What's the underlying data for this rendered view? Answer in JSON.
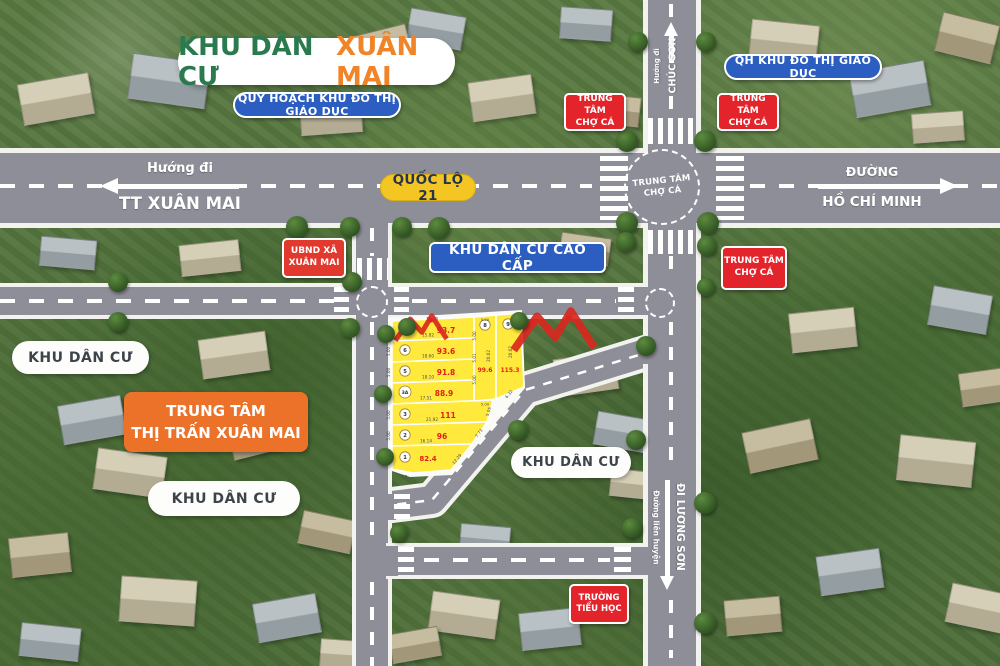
{
  "title": {
    "part1": "KHU DÂN CƯ",
    "part2": "XUÂN MAI"
  },
  "badges": {
    "quy_hoach": "QUY HOẠCH KHU ĐÔ THỊ GIÁO DỤC",
    "qh_giao_duc": "QH KHU ĐÔ THỊ GIÁO DỤC",
    "cho_ca_line1": "TRUNG TÂM",
    "cho_ca_line2": "CHỢ CÁ",
    "quoc_lo": "QUỐC LỘ 21",
    "ubnd_line1": "UBND XÃ",
    "ubnd_line2": "XUÂN MAI",
    "cao_cap": "KHU DÂN CƯ CAO CẤP",
    "khu_dan_cu": "KHU DÂN CƯ",
    "trung_tam_line1": "TRUNG TÂM",
    "trung_tam_line2": "THỊ TRẤN XUÂN MAI",
    "truong_line1": "TRƯỜNG",
    "truong_line2": "TIỂU HỌC"
  },
  "directions": {
    "west_small": "Hướng đi",
    "west_big": "TT XUÂN MAI",
    "east_small": "ĐƯỜNG",
    "east_big": "HỒ CHÍ MINH",
    "north_small": "Hướng đi",
    "north_big": "CHÚC SƠN",
    "south_small": "Đường liên huyện",
    "south_big": "ĐI LƯƠNG SƠN"
  },
  "roundabout": {
    "line1": "TRUNG TÂM",
    "line2": "CHỢ CÁ"
  },
  "plots": {
    "p1": {
      "num": "1",
      "area": "82.4",
      "w": "7.3",
      "e": "5.00",
      "d": "12.29"
    },
    "p2": {
      "num": "2",
      "area": "96",
      "w": "16.14",
      "e": "5.00",
      "d": "7.73"
    },
    "p3": {
      "num": "3",
      "area": "111",
      "w": "21.92",
      "e": "5.00",
      "d": "5.05"
    },
    "p3a": {
      "num": "3A",
      "area": "88.9",
      "w": "17.51",
      "e": "5.00"
    },
    "p5": {
      "num": "5",
      "area": "91.8",
      "w": "18.10",
      "e": "5.00"
    },
    "p6": {
      "num": "6",
      "area": "93.6",
      "w": "18.60",
      "e": "5.00"
    },
    "p7": {
      "num": "7",
      "area": "93.7",
      "w": "15.82",
      "t": "17.80",
      "e": "5.32"
    },
    "p8": {
      "num": "8",
      "area": "99.6",
      "h": "20.02",
      "t": "5.00",
      "e1": "5.00",
      "e2": "5.01",
      "e3": "5.00",
      "b": "5.00"
    },
    "p9": {
      "num": "9",
      "area": "115.3",
      "h": "20.07",
      "b": "6.32"
    }
  },
  "colors": {
    "road": "#8d8e97",
    "plot_yellow": "#ffe93d",
    "badge_red": "#e3242b",
    "badge_blue": "#2b5ec0",
    "badge_orange": "#ed7229",
    "title_green": "#2a7a4d",
    "title_orange": "#f08428",
    "highway_badge_yellow": "#f3c623",
    "area_text_red": "#e31e18"
  }
}
